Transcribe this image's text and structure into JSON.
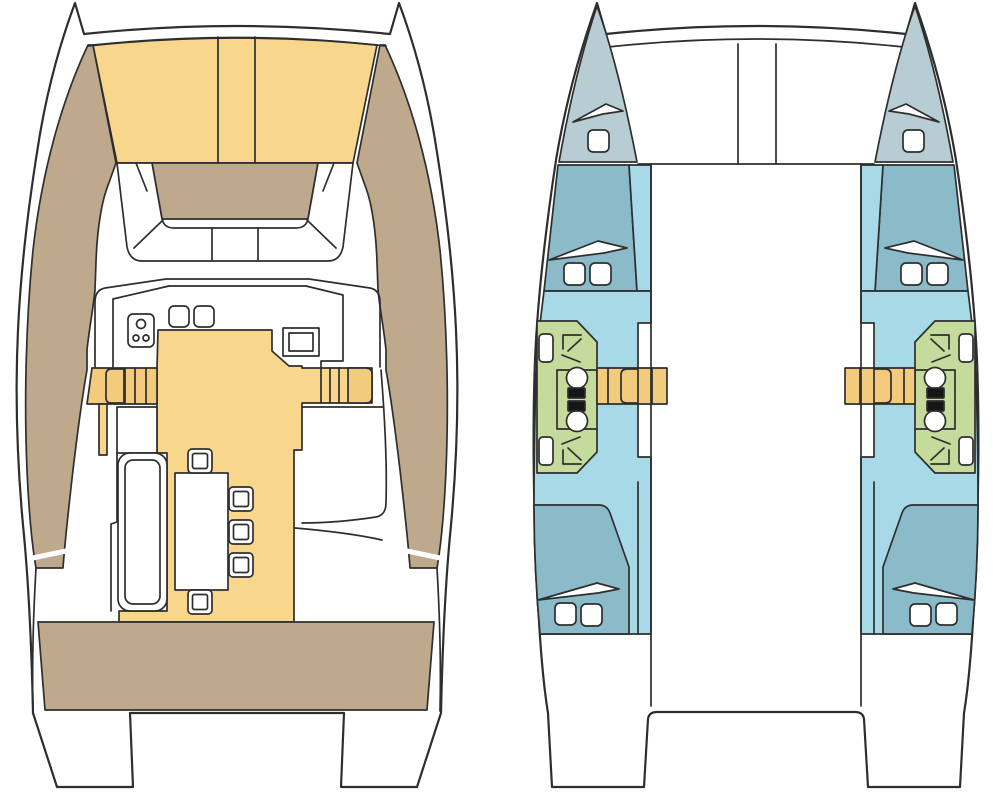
{
  "canvas": {
    "width": 993,
    "height": 798
  },
  "diagram": {
    "type": "boat-floor-plan",
    "subject": "catamaran",
    "views": 2
  },
  "colors": {
    "line": "#2e2e2e",
    "hull": "#ffffff",
    "deck": "#bea98c",
    "sunpad": "#f8d68c",
    "steps": "#f3cb7d",
    "bow": "#b8cdd3",
    "cabin": "#8bbac8",
    "passage": "#a8d9e6",
    "green": "#c4db9b",
    "fixture": "#161616"
  }
}
